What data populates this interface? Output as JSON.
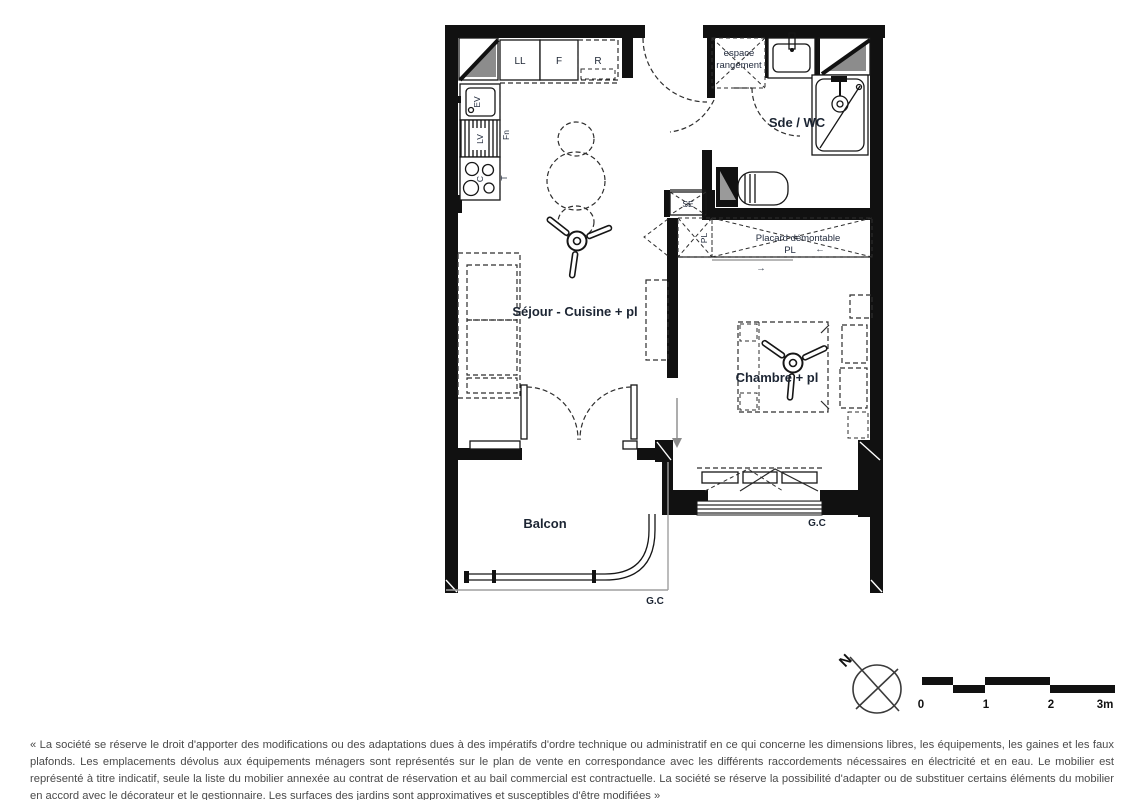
{
  "plan": {
    "rooms": {
      "sejour": "Séjour - Cuisine + pl",
      "chambre": "Chambre + pl",
      "sde_wc": "Sde / WC",
      "balcon": "Balcon"
    },
    "storage": {
      "espace_line1": "espace",
      "espace_line2": "rangement",
      "placard_demontable": "Placard démontable",
      "placard_pl": "PL",
      "hall_pl": "PL",
      "se": "SE"
    },
    "kitchen": {
      "ll": "LL",
      "f": "F",
      "r": "R",
      "ev": "EV",
      "lv": "LV",
      "c": "C",
      "fn": "Fn",
      "t": "T"
    },
    "guardrail": {
      "balcony": "G.C",
      "bedroom": "G.C"
    },
    "arrows": {
      "left": "←",
      "right": "→"
    }
  },
  "compass": {
    "north": "N"
  },
  "scalebar": {
    "labels": [
      "0",
      "1",
      "2",
      "3m"
    ]
  },
  "disclaimer": "« La société se réserve le droit d'apporter des modifications ou des adaptations dues à des impératifs d'ordre technique ou administratif en ce qui concerne les dimensions libres, les équipements, les gaines et les faux plafonds. Les emplacements dévolus aux équipements ménagers sont représentés sur le plan de vente en correspondance avec les différents raccordements nécessaires en électricité et en eau. Le mobilier est représenté à titre indicatif, seule la liste du mobilier annexée au contrat de réservation et au bail commercial est contractuelle. La société se réserve la possibilité d'adapter ou de substituer certains éléments du mobilier en accord avec le décorateur et le gestionnaire. Les surfaces des jardins sont approximatives et susceptibles d'être modifiées »",
  "colors": {
    "wall": "#111111",
    "corner_shade": "#8c8c8c",
    "label": "#1c2533",
    "disclaimer_text": "#4a4a4a"
  }
}
